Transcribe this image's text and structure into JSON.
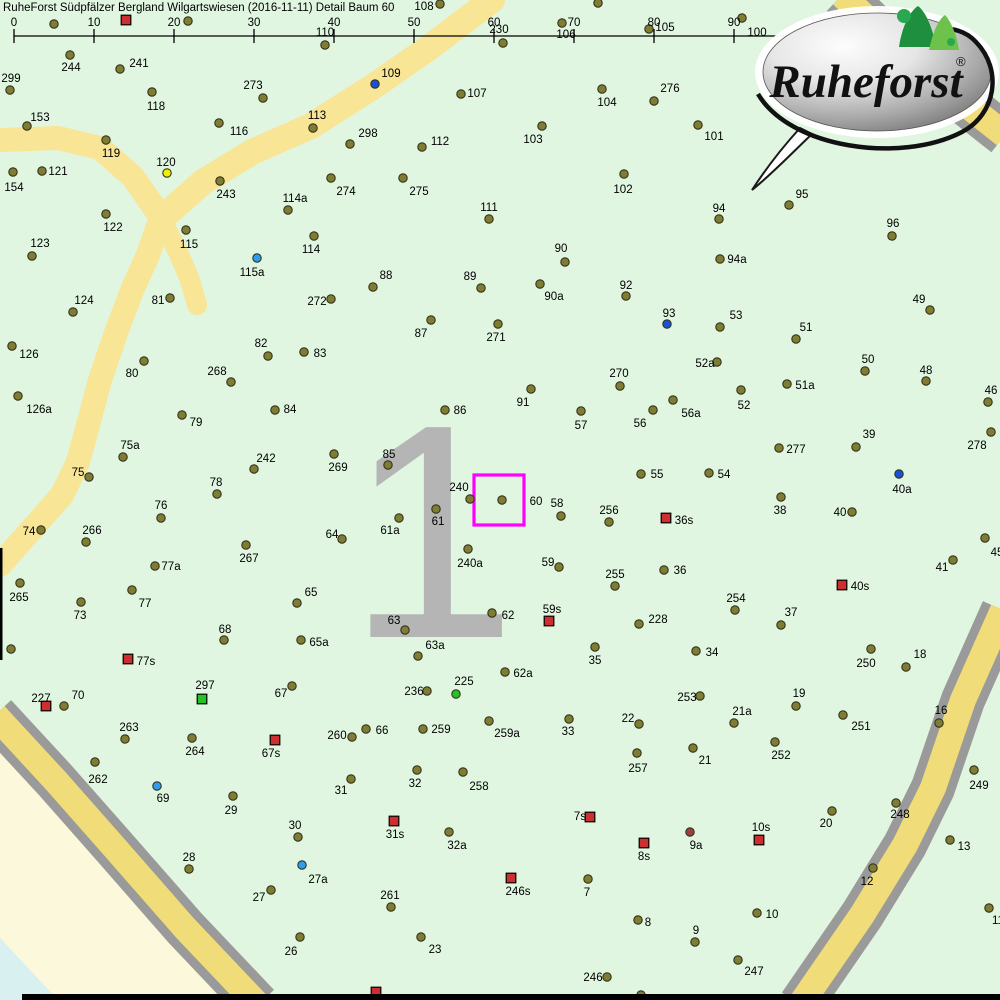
{
  "title": "RuheForst Südpfälzer Bergland Wilgartswiesen (2016-11-11) Detail  Baum 60",
  "scale_bar": {
    "y": 36,
    "x0": 14,
    "step": 80,
    "tick_labels": [
      "0",
      "10",
      "20",
      "30",
      "40",
      "50",
      "60",
      "70",
      "80",
      "90",
      "100m"
    ]
  },
  "logo": {
    "brand": "Ruheforst",
    "reg": "®"
  },
  "selection": {
    "label": "60",
    "x": 474,
    "y": 475,
    "w": 50,
    "h": 50
  },
  "watermark": {
    "text": "1",
    "x": 432,
    "y": 637,
    "size": 305
  },
  "colors": {
    "bg": "#e0f6e1",
    "outside": "#fbf8dc",
    "water": "#d8f0f0",
    "road": "#f8e596",
    "boundary_road": "#f0dc78",
    "road_edge": "#9a9a9a",
    "tree": "#7f7c33",
    "tree_stroke": "#33331a",
    "blue": "#1b50d8",
    "light_blue": "#2e9df0",
    "yellow": "#f0f000",
    "green": "#25c425",
    "red": "#cc2f2f",
    "dark_red": "#9a4040",
    "selection": "#ff00ff",
    "watermark": "#b5b5b5",
    "label": "#000000",
    "frame": "#000000"
  },
  "roads": {
    "interior": [
      {
        "w": 24,
        "pts": [
          [
            0,
            140
          ],
          [
            58,
            138
          ],
          [
            100,
            148
          ],
          [
            133,
            177
          ],
          [
            158,
            213
          ]
        ]
      },
      {
        "w": 26,
        "pts": [
          [
            492,
            0
          ],
          [
            430,
            47
          ],
          [
            374,
            86
          ],
          [
            311,
            126
          ],
          [
            252,
            152
          ],
          [
            203,
            182
          ],
          [
            162,
            218
          ]
        ]
      },
      {
        "w": 24,
        "pts": [
          [
            160,
            220
          ],
          [
            148,
            255
          ],
          [
            133,
            288
          ],
          [
            117,
            330
          ],
          [
            100,
            380
          ],
          [
            88,
            425
          ],
          [
            78,
            462
          ],
          [
            62,
            495
          ],
          [
            40,
            520
          ],
          [
            15,
            548
          ],
          [
            0,
            565
          ]
        ]
      },
      {
        "w": 20,
        "pts": [
          [
            162,
            220
          ],
          [
            178,
            252
          ],
          [
            190,
            280
          ],
          [
            197,
            305
          ]
        ]
      }
    ],
    "boundary": [
      {
        "pts": [
          [
            -5,
            715
          ],
          [
            55,
            780
          ],
          [
            115,
            848
          ],
          [
            185,
            928
          ],
          [
            258,
            1005
          ]
        ]
      },
      {
        "pts": [
          [
            1003,
            610
          ],
          [
            963,
            700
          ],
          [
            933,
            788
          ],
          [
            905,
            845
          ],
          [
            862,
            915
          ],
          [
            800,
            1005
          ]
        ]
      },
      {
        "pts": [
          [
            842,
            -5
          ],
          [
            910,
            60
          ],
          [
            1005,
            135
          ]
        ]
      }
    ],
    "outside_polygon": [
      [
        0,
        712
      ],
      [
        55,
        778
      ],
      [
        115,
        848
      ],
      [
        185,
        928
      ],
      [
        252,
        1000
      ],
      [
        0,
        1000
      ]
    ],
    "water_polygon": [
      [
        0,
        938
      ],
      [
        58,
        1000
      ],
      [
        0,
        1000
      ]
    ]
  },
  "frame_bars": {
    "bottom": {
      "x": 22,
      "y": 994,
      "w": 978,
      "h": 6
    },
    "left": {
      "x": 0,
      "y": 548,
      "w": 2.5,
      "h": 112
    }
  },
  "markers": [
    [
      "",
      54,
      24,
      0,
      0,
      "o"
    ],
    [
      "",
      126,
      20,
      0,
      0,
      "rs"
    ],
    [
      "",
      188,
      21,
      0,
      0,
      "o"
    ],
    [
      "110",
      325,
      45,
      325,
      32,
      "o"
    ],
    [
      "108",
      440,
      4,
      424,
      6,
      "o"
    ],
    [
      "",
      598,
      3,
      0,
      0,
      "o"
    ],
    [
      "230",
      503,
      43,
      499,
      29,
      "o"
    ],
    [
      "106",
      562,
      23,
      566,
      34,
      "o"
    ],
    [
      "105",
      649,
      29,
      665,
      27,
      "o"
    ],
    [
      "100",
      742,
      18,
      757,
      32,
      "o"
    ],
    [
      "299",
      10,
      90,
      11,
      78,
      "o"
    ],
    [
      "244",
      70,
      55,
      71,
      67,
      "o"
    ],
    [
      "241",
      120,
      69,
      139,
      63,
      "o"
    ],
    [
      "118",
      152,
      92,
      156,
      106,
      "o"
    ],
    [
      "153",
      27,
      126,
      40,
      117,
      "o"
    ],
    [
      "116",
      219,
      123,
      239,
      131,
      "o"
    ],
    [
      "119",
      106,
      140,
      111,
      153,
      "o"
    ],
    [
      "120",
      167,
      173,
      166,
      162,
      "y"
    ],
    [
      "121",
      42,
      171,
      58,
      171,
      "o"
    ],
    [
      "154",
      13,
      172,
      14,
      187,
      "o"
    ],
    [
      "243",
      220,
      181,
      226,
      194,
      "o"
    ],
    [
      "122",
      106,
      214,
      113,
      227,
      "o"
    ],
    [
      "115",
      186,
      230,
      189,
      244,
      "o"
    ],
    [
      "123",
      32,
      256,
      40,
      243,
      "o"
    ],
    [
      "124",
      73,
      312,
      84,
      300,
      "o"
    ],
    [
      "81",
      170,
      298,
      158,
      300,
      "o"
    ],
    [
      "273",
      263,
      98,
      253,
      85,
      "o"
    ],
    [
      "109",
      375,
      84,
      391,
      73,
      "b"
    ],
    [
      "107",
      461,
      94,
      477,
      93,
      "o"
    ],
    [
      "113",
      313,
      128,
      317,
      115,
      "o"
    ],
    [
      "298",
      350,
      144,
      368,
      133,
      "o"
    ],
    [
      "112",
      422,
      147,
      440,
      141,
      "o"
    ],
    [
      "274",
      331,
      178,
      346,
      191,
      "o"
    ],
    [
      "275",
      403,
      178,
      419,
      191,
      "o"
    ],
    [
      "114a",
      288,
      210,
      295,
      198,
      "o"
    ],
    [
      "111",
      489,
      219,
      489,
      207,
      "o"
    ],
    [
      "114",
      314,
      236,
      311,
      249,
      "o"
    ],
    [
      "115a",
      257,
      258,
      252,
      272,
      "c"
    ],
    [
      "88",
      373,
      287,
      386,
      275,
      "o"
    ],
    [
      "89",
      481,
      288,
      470,
      276,
      "o"
    ],
    [
      "272",
      331,
      299,
      317,
      301,
      "o"
    ],
    [
      "104",
      602,
      89,
      607,
      102,
      "o"
    ],
    [
      "276",
      654,
      101,
      670,
      88,
      "o"
    ],
    [
      "103",
      542,
      126,
      533,
      139,
      "o"
    ],
    [
      "101",
      698,
      125,
      714,
      136,
      "o"
    ],
    [
      "102",
      624,
      174,
      623,
      189,
      "o"
    ],
    [
      "94",
      719,
      219,
      719,
      208,
      "o"
    ],
    [
      "90",
      565,
      262,
      561,
      248,
      "o"
    ],
    [
      "94a",
      720,
      259,
      737,
      259,
      "o"
    ],
    [
      "90a",
      540,
      284,
      554,
      296,
      "o"
    ],
    [
      "92",
      626,
      296,
      626,
      285,
      "o"
    ],
    [
      "95",
      789,
      205,
      802,
      194,
      "o"
    ],
    [
      "96",
      892,
      236,
      893,
      223,
      "o"
    ],
    [
      "49",
      930,
      310,
      919,
      299,
      "o"
    ],
    [
      "126",
      12,
      346,
      29,
      354,
      "o"
    ],
    [
      "80",
      144,
      361,
      132,
      373,
      "o"
    ],
    [
      "268",
      231,
      382,
      217,
      371,
      "o"
    ],
    [
      "126a",
      18,
      396,
      39,
      409,
      "o"
    ],
    [
      "79",
      182,
      415,
      196,
      422,
      "o"
    ],
    [
      "75a",
      123,
      457,
      130,
      445,
      "o"
    ],
    [
      "75",
      89,
      477,
      78,
      472,
      "o"
    ],
    [
      "78",
      217,
      494,
      216,
      482,
      "o"
    ],
    [
      "76",
      161,
      518,
      161,
      505,
      "o"
    ],
    [
      "74",
      41,
      530,
      29,
      531,
      "o"
    ],
    [
      "266",
      86,
      542,
      92,
      530,
      "o"
    ],
    [
      "87",
      431,
      320,
      421,
      333,
      "o"
    ],
    [
      "271",
      498,
      324,
      496,
      337,
      "o"
    ],
    [
      "82",
      268,
      356,
      261,
      343,
      "o"
    ],
    [
      "83",
      304,
      352,
      320,
      353,
      "o"
    ],
    [
      "84",
      275,
      410,
      290,
      409,
      "o"
    ],
    [
      "86",
      445,
      410,
      460,
      410,
      "o"
    ],
    [
      "269",
      334,
      454,
      338,
      467,
      "o"
    ],
    [
      "242",
      254,
      469,
      266,
      458,
      "o"
    ],
    [
      "85",
      388,
      465,
      389,
      454,
      "o"
    ],
    [
      "240",
      470,
      499,
      459,
      487,
      "o"
    ],
    [
      "60",
      502,
      500,
      536,
      501,
      "o"
    ],
    [
      "61",
      436,
      509,
      438,
      521,
      "o"
    ],
    [
      "61a",
      399,
      518,
      390,
      530,
      "o"
    ],
    [
      "64",
      342,
      539,
      332,
      534,
      "o"
    ],
    [
      "240a",
      468,
      549,
      470,
      563,
      "o"
    ],
    [
      "93",
      667,
      324,
      669,
      313,
      "b"
    ],
    [
      "53",
      720,
      327,
      736,
      315,
      "o"
    ],
    [
      "52a",
      717,
      362,
      705,
      363,
      "o"
    ],
    [
      "270",
      620,
      386,
      619,
      373,
      "o"
    ],
    [
      "91",
      531,
      389,
      523,
      402,
      "o"
    ],
    [
      "52",
      741,
      390,
      744,
      405,
      "o"
    ],
    [
      "56a",
      673,
      400,
      691,
      413,
      "o"
    ],
    [
      "57",
      581,
      411,
      581,
      425,
      "o"
    ],
    [
      "56",
      653,
      410,
      640,
      423,
      "o"
    ],
    [
      "55",
      641,
      474,
      657,
      474,
      "o"
    ],
    [
      "54",
      709,
      473,
      724,
      474,
      "o"
    ],
    [
      "58",
      561,
      516,
      557,
      503,
      "o"
    ],
    [
      "256",
      609,
      522,
      609,
      510,
      "o"
    ],
    [
      "36s",
      666,
      518,
      684,
      520,
      "rs"
    ],
    [
      "51",
      796,
      339,
      806,
      327,
      "o"
    ],
    [
      "50",
      865,
      371,
      868,
      359,
      "o"
    ],
    [
      "48",
      926,
      381,
      926,
      370,
      "o"
    ],
    [
      "51a",
      787,
      384,
      805,
      385,
      "o"
    ],
    [
      "46",
      988,
      402,
      991,
      390,
      "o"
    ],
    [
      "39",
      856,
      447,
      869,
      434,
      "o"
    ],
    [
      "278",
      991,
      432,
      977,
      445,
      "o"
    ],
    [
      "277",
      779,
      448,
      796,
      449,
      "o"
    ],
    [
      "40a",
      899,
      474,
      902,
      489,
      "b"
    ],
    [
      "38",
      781,
      497,
      780,
      510,
      "o"
    ],
    [
      "40",
      852,
      512,
      840,
      512,
      "o"
    ],
    [
      "45",
      985,
      538,
      997,
      552,
      "o"
    ],
    [
      "77a",
      155,
      566,
      171,
      566,
      "o"
    ],
    [
      "265",
      20,
      583,
      19,
      597,
      "o"
    ],
    [
      "77",
      132,
      590,
      145,
      603,
      "o"
    ],
    [
      "73",
      81,
      602,
      80,
      615,
      "o"
    ],
    [
      "68",
      224,
      640,
      225,
      629,
      "o"
    ],
    [
      "",
      11,
      649,
      0,
      0,
      "o"
    ],
    [
      "77s",
      128,
      659,
      146,
      661,
      "rs"
    ],
    [
      "297",
      202,
      699,
      205,
      685,
      "gs"
    ],
    [
      "227",
      46,
      706,
      41,
      698,
      "rs"
    ],
    [
      "70",
      64,
      706,
      78,
      695,
      "o"
    ],
    [
      "263",
      125,
      739,
      129,
      727,
      "o"
    ],
    [
      "264",
      192,
      738,
      195,
      751,
      "o"
    ],
    [
      "262",
      95,
      762,
      98,
      779,
      "o"
    ],
    [
      "69",
      157,
      786,
      163,
      798,
      "c"
    ],
    [
      "267",
      246,
      545,
      249,
      558,
      "o"
    ],
    [
      "65",
      297,
      603,
      311,
      592,
      "o"
    ],
    [
      "63",
      405,
      630,
      394,
      620,
      "o"
    ],
    [
      "65a",
      301,
      640,
      319,
      642,
      "o"
    ],
    [
      "63a",
      418,
      656,
      435,
      645,
      "o"
    ],
    [
      "62",
      492,
      613,
      508,
      615,
      "o"
    ],
    [
      "67",
      292,
      686,
      281,
      693,
      "o"
    ],
    [
      "236",
      427,
      691,
      414,
      691,
      "o"
    ],
    [
      "225",
      456,
      694,
      464,
      681,
      "g"
    ],
    [
      "260",
      352,
      737,
      337,
      735,
      "o"
    ],
    [
      "66",
      366,
      729,
      382,
      730,
      "o"
    ],
    [
      "259",
      423,
      729,
      441,
      729,
      "o"
    ],
    [
      "259a",
      489,
      721,
      507,
      733,
      "o"
    ],
    [
      "67s",
      275,
      740,
      271,
      753,
      "rs"
    ],
    [
      "31",
      351,
      779,
      341,
      790,
      "o"
    ],
    [
      "32",
      417,
      770,
      415,
      783,
      "o"
    ],
    [
      "258",
      463,
      772,
      479,
      786,
      "o"
    ],
    [
      "59",
      559,
      567,
      548,
      562,
      "o"
    ],
    [
      "36",
      664,
      570,
      680,
      570,
      "o"
    ],
    [
      "255",
      615,
      586,
      615,
      574,
      "o"
    ],
    [
      "254",
      735,
      610,
      736,
      598,
      "o"
    ],
    [
      "59s",
      549,
      621,
      552,
      609,
      "rs"
    ],
    [
      "228",
      639,
      624,
      658,
      619,
      "o"
    ],
    [
      "35",
      595,
      647,
      595,
      660,
      "o"
    ],
    [
      "34",
      696,
      651,
      712,
      652,
      "o"
    ],
    [
      "62a",
      505,
      672,
      523,
      673,
      "o"
    ],
    [
      "253",
      700,
      696,
      687,
      697,
      "o"
    ],
    [
      "21a",
      734,
      723,
      742,
      711,
      "o"
    ],
    [
      "33",
      569,
      719,
      568,
      731,
      "o"
    ],
    [
      "22",
      639,
      724,
      628,
      718,
      "o"
    ],
    [
      "21",
      693,
      748,
      705,
      760,
      "o"
    ],
    [
      "257",
      637,
      753,
      638,
      768,
      "o"
    ],
    [
      "41",
      953,
      560,
      942,
      567,
      "o"
    ],
    [
      "40s",
      842,
      585,
      860,
      586,
      "rs"
    ],
    [
      "37",
      781,
      625,
      791,
      612,
      "o"
    ],
    [
      "250",
      871,
      649,
      866,
      663,
      "o"
    ],
    [
      "18",
      906,
      667,
      920,
      654,
      "o"
    ],
    [
      "19",
      796,
      706,
      799,
      693,
      "o"
    ],
    [
      "16",
      939,
      723,
      941,
      710,
      "o"
    ],
    [
      "251",
      843,
      715,
      861,
      726,
      "o"
    ],
    [
      "252",
      775,
      742,
      781,
      755,
      "o"
    ],
    [
      "249",
      974,
      770,
      979,
      785,
      "o"
    ],
    [
      "29",
      233,
      796,
      231,
      810,
      "o"
    ],
    [
      "28",
      189,
      869,
      189,
      857,
      "o"
    ],
    [
      "27",
      271,
      890,
      259,
      897,
      "o"
    ],
    [
      "30",
      298,
      837,
      295,
      825,
      "o"
    ],
    [
      "31s",
      394,
      821,
      395,
      834,
      "rs"
    ],
    [
      "32a",
      449,
      832,
      457,
      845,
      "o"
    ],
    [
      "27a",
      302,
      865,
      318,
      879,
      "c"
    ],
    [
      "261",
      391,
      907,
      390,
      895,
      "o"
    ],
    [
      "26",
      300,
      937,
      291,
      951,
      "o"
    ],
    [
      "23",
      421,
      937,
      435,
      949,
      "o"
    ],
    [
      "",
      376,
      992,
      0,
      0,
      "rs"
    ],
    [
      "",
      641,
      995,
      0,
      0,
      "o"
    ],
    [
      "7s",
      590,
      817,
      580,
      816,
      "rs"
    ],
    [
      "9a",
      690,
      832,
      696,
      845,
      "dr"
    ],
    [
      "8s",
      644,
      843,
      644,
      856,
      "rs"
    ],
    [
      "246s",
      511,
      878,
      518,
      891,
      "rs"
    ],
    [
      "7",
      588,
      879,
      587,
      892,
      "o"
    ],
    [
      "8",
      638,
      920,
      648,
      922,
      "o"
    ],
    [
      "9",
      695,
      942,
      696,
      930,
      "o"
    ],
    [
      "246",
      607,
      977,
      593,
      977,
      "o"
    ],
    [
      "247",
      738,
      960,
      754,
      971,
      "o"
    ],
    [
      "10s",
      759,
      840,
      761,
      827,
      "rs"
    ],
    [
      "20",
      832,
      811,
      826,
      823,
      "o"
    ],
    [
      "248",
      896,
      803,
      900,
      814,
      "o"
    ],
    [
      "13",
      950,
      840,
      964,
      846,
      "o"
    ],
    [
      "12",
      873,
      868,
      867,
      881,
      "o"
    ],
    [
      "10",
      757,
      913,
      772,
      914,
      "o"
    ],
    [
      "11",
      989,
      908,
      998,
      920,
      "o"
    ]
  ]
}
